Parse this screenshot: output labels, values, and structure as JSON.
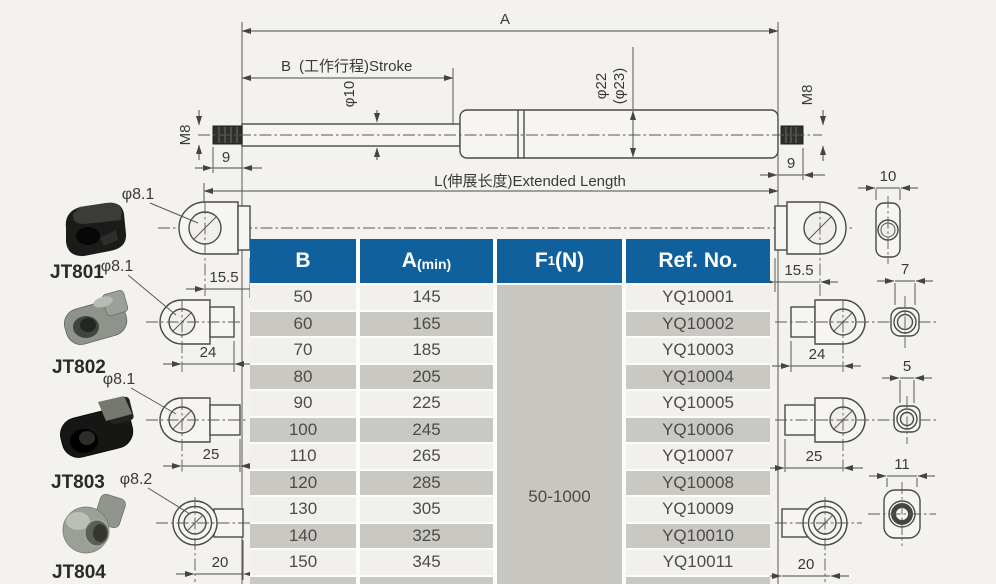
{
  "drawing": {
    "dim_a": "A",
    "dim_b_letter": "B",
    "dim_b_rest": "(工作行程)Stroke",
    "phi_rod": "φ10",
    "phi_tube": "φ22",
    "phi_tube_alt": "(φ23)",
    "m8_left": "M8",
    "m8_right": "M8",
    "nine_left": "9",
    "nine_right": "9",
    "extended_length": "L(伸展长度)Extended Length"
  },
  "fittings_left": [
    {
      "id": "JT801",
      "phi": "φ8.1",
      "dim": "15.5"
    },
    {
      "id": "JT802",
      "phi": "φ8.1",
      "dim": "24"
    },
    {
      "id": "JT803",
      "phi": "φ8.1",
      "dim": "25"
    },
    {
      "id": "JT804",
      "phi": "φ8.2",
      "dim": "20"
    }
  ],
  "fittings_right": {
    "eyelet_dims": [
      "15.5",
      "24",
      "25",
      "20"
    ],
    "side_view_widths": [
      "10",
      "7",
      "5",
      "11"
    ]
  },
  "table": {
    "headers": {
      "b": "B",
      "a_main": "A",
      "a_paren": "(min)",
      "f_main": "F",
      "f_sub": "1",
      "f_paren": "(N)",
      "ref": "Ref. No."
    },
    "f1_value": "50-1000",
    "rows": [
      {
        "b": "50",
        "a": "145",
        "ref": "YQ10001"
      },
      {
        "b": "60",
        "a": "165",
        "ref": "YQ10002"
      },
      {
        "b": "70",
        "a": "185",
        "ref": "YQ10003"
      },
      {
        "b": "80",
        "a": "205",
        "ref": "YQ10004"
      },
      {
        "b": "90",
        "a": "225",
        "ref": "YQ10005"
      },
      {
        "b": "100",
        "a": "245",
        "ref": "YQ10006"
      },
      {
        "b": "110",
        "a": "265",
        "ref": "YQ10007"
      },
      {
        "b": "120",
        "a": "285",
        "ref": "YQ10008"
      },
      {
        "b": "130",
        "a": "305",
        "ref": "YQ10009"
      },
      {
        "b": "140",
        "a": "325",
        "ref": "YQ10010"
      },
      {
        "b": "150",
        "a": "345",
        "ref": "YQ10011"
      }
    ],
    "colors": {
      "header_blue": "#11609e",
      "row_light": "#f1f0ec",
      "row_dark": "#c9c8c3"
    }
  }
}
